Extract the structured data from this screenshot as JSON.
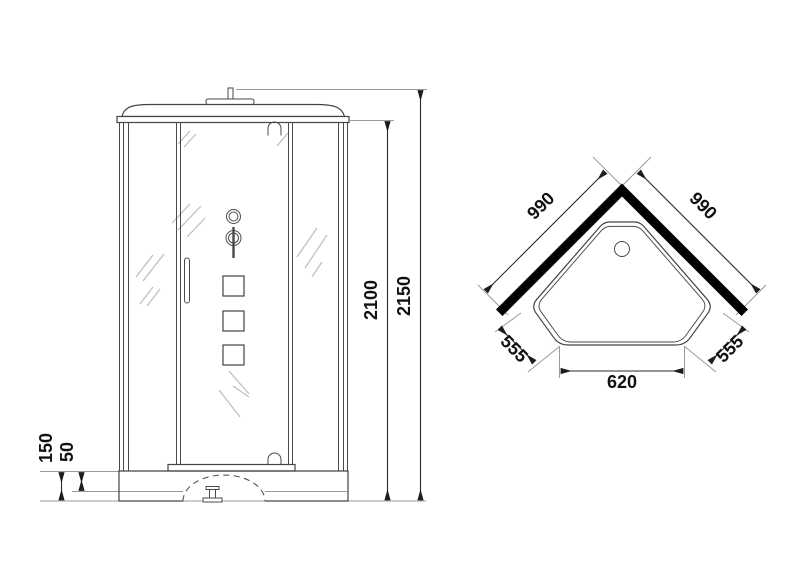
{
  "page": {
    "title": "Shower cabin dimensions drawing",
    "background": "#ffffff"
  },
  "colors": {
    "outline": "#4a4a4a",
    "dimension_line": "#2a2a2a",
    "extension_line": "#9a9a9a",
    "glass_hatch": "#bdbdbd",
    "wall_fill": "#000000",
    "text": "#111111"
  },
  "front_view": {
    "label": "front-elevation",
    "dims": {
      "overall_height": "2150",
      "cabin_height": "2100",
      "base_height": "150",
      "tray_rim_height": "50"
    }
  },
  "plan_view": {
    "label": "top-plan",
    "dims": {
      "wall_left": "990",
      "wall_right": "990",
      "side_left": "555",
      "side_right": "555",
      "front_width": "620"
    }
  }
}
